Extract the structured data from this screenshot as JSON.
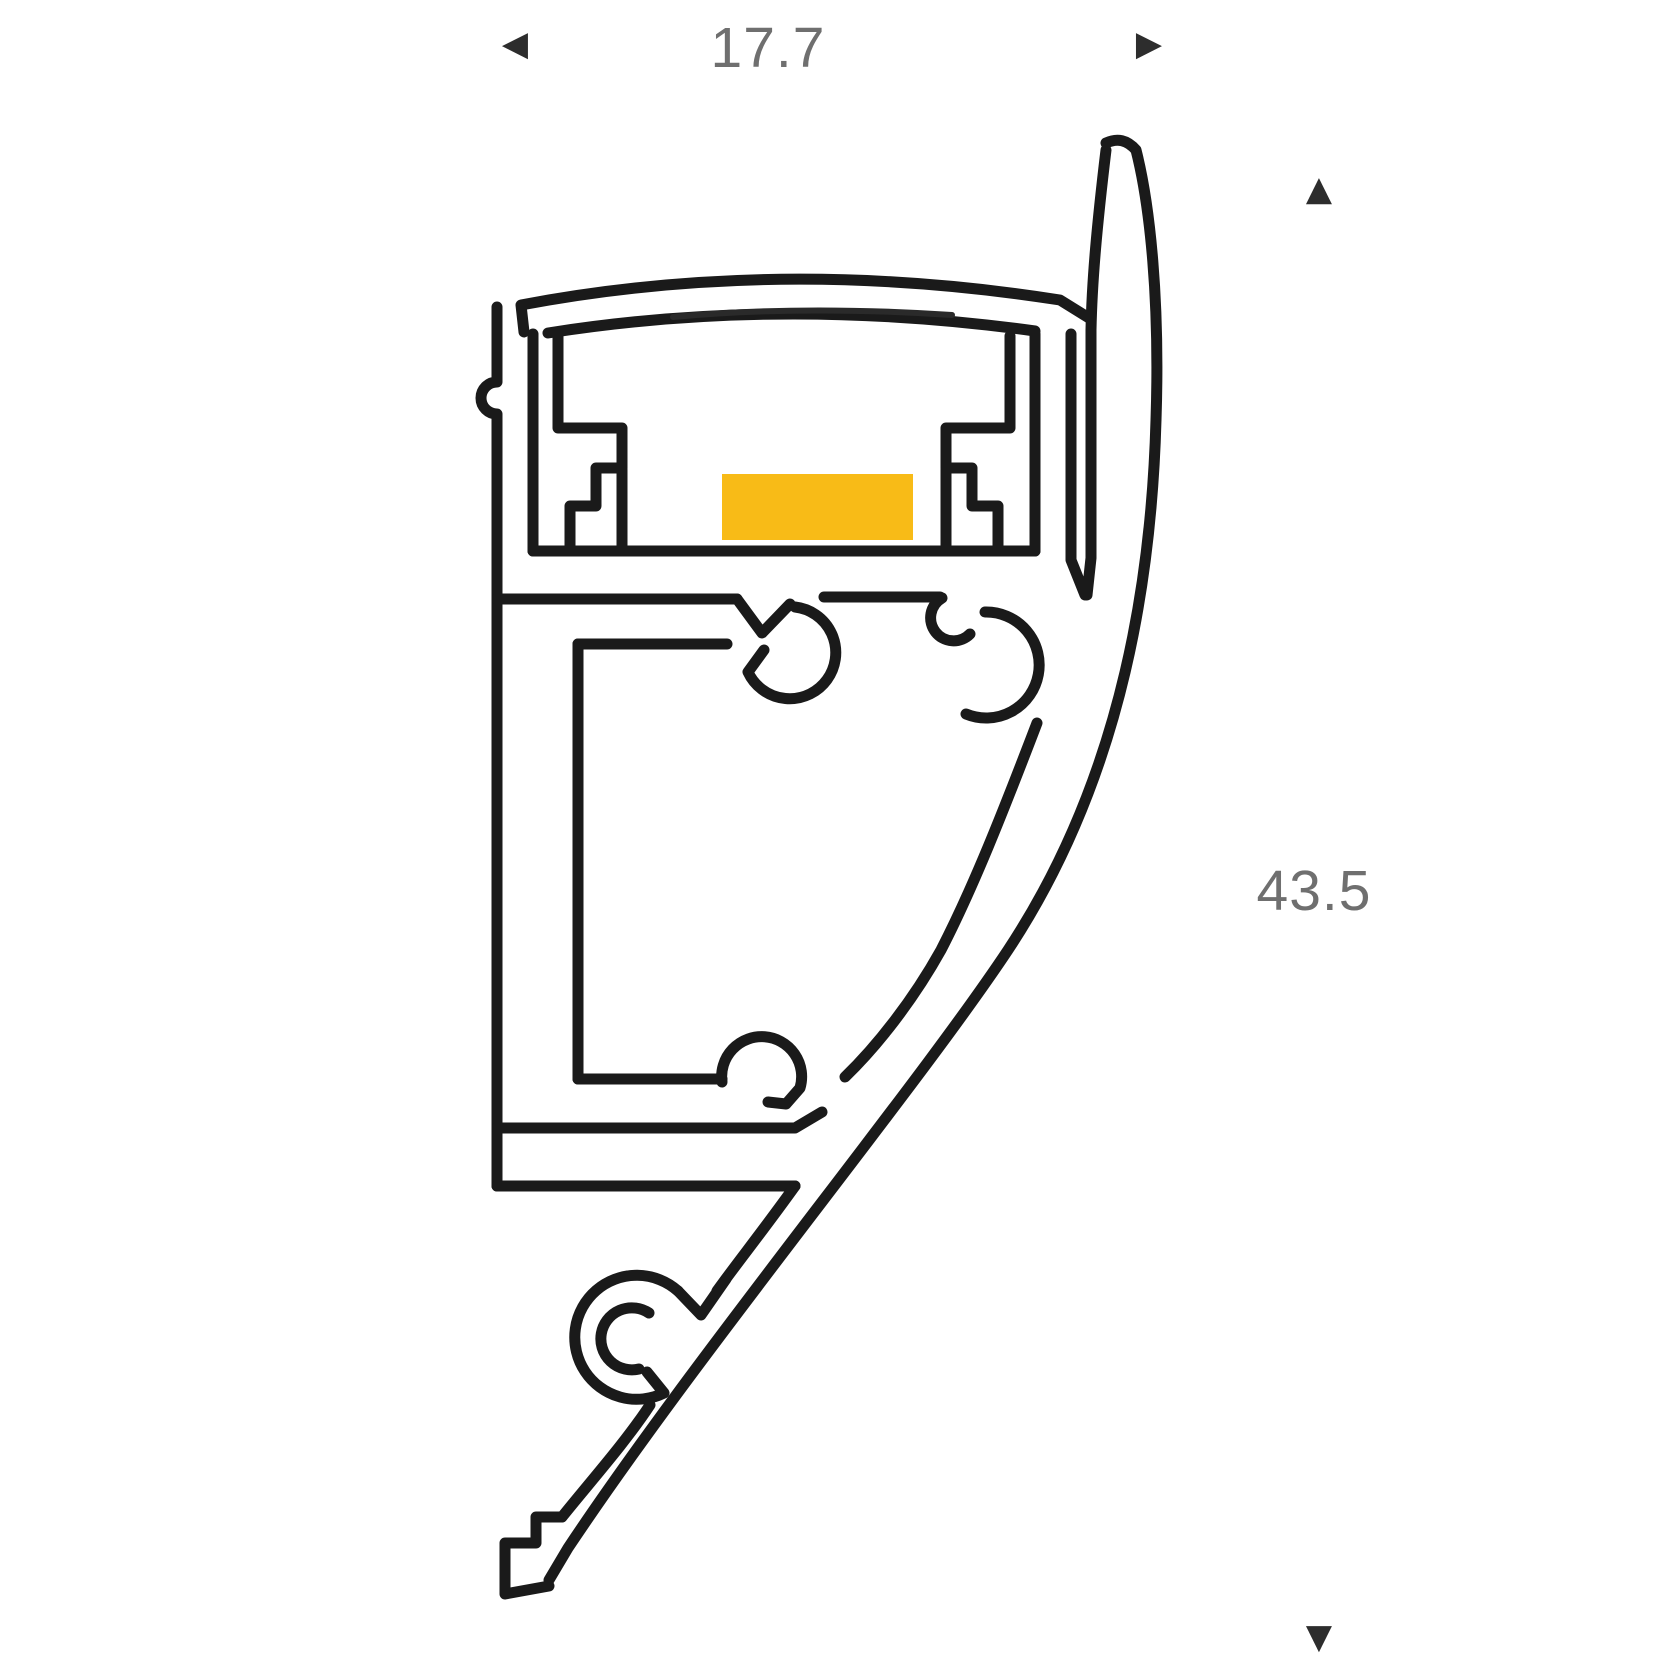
{
  "page": {
    "background_color": "#ffffff"
  },
  "diagram": {
    "title": "LED aluminium wall profile cross-section",
    "line_color": "#1a1a1a",
    "dim_text_color": "#6f6f6f",
    "arrow_color": "#2d2d2d",
    "led_strip": {
      "color": "#f8bb17"
    },
    "dimensions": {
      "width": {
        "value": "17.7"
      },
      "height": {
        "value": "43.5"
      }
    }
  },
  "icons": {
    "arrow_left": "◀",
    "arrow_right": "▶",
    "arrow_up": "▲",
    "arrow_down": "▼"
  }
}
